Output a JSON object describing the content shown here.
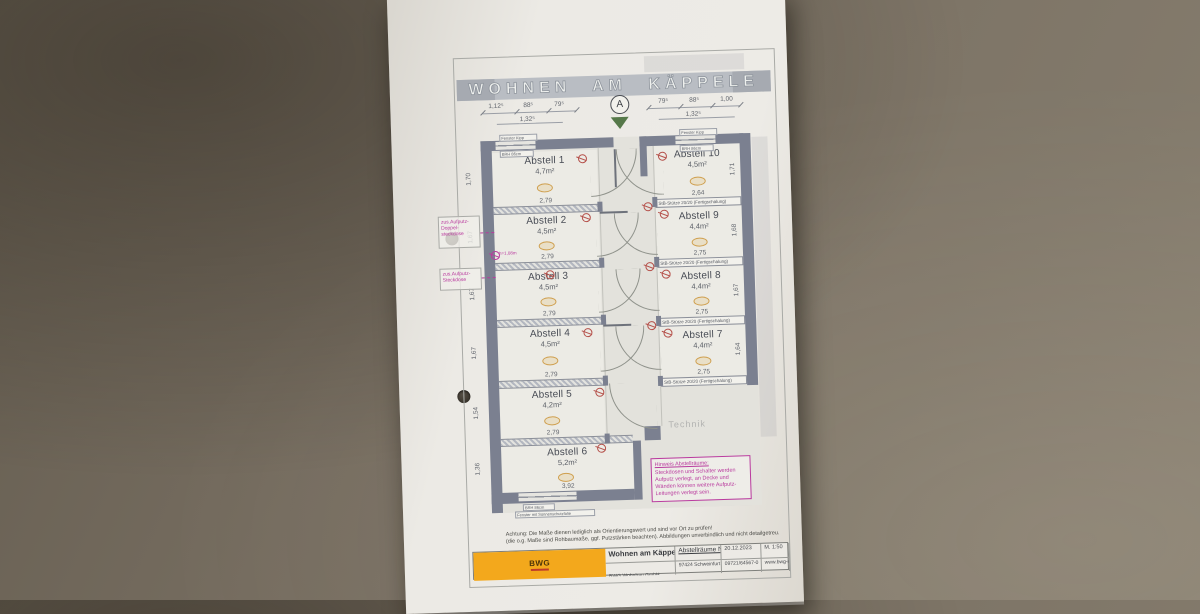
{
  "banner": {
    "title": "WOHNEN AM KÄPPELE"
  },
  "north": {
    "label": "A"
  },
  "dims": {
    "top_left": [
      "1,12⁵",
      "88⁵",
      "79⁵"
    ],
    "top_left_sub": "1,32⁵",
    "top_right": [
      "79⁵",
      "88⁵",
      "1,00"
    ],
    "top_right_sub": "1,32⁵"
  },
  "rooms_left": [
    {
      "name": "Abstell 1",
      "area": "4,7m²",
      "w": "2,79",
      "h": "1,70"
    },
    {
      "name": "Abstell 2",
      "area": "4,5m²",
      "w": "2,79",
      "h": "1,67"
    },
    {
      "name": "Abstell 3",
      "area": "4,5m²",
      "w": "2,79",
      "h": "1,67"
    },
    {
      "name": "Abstell 4",
      "area": "4,5m²",
      "w": "2,79",
      "h": "1,67"
    },
    {
      "name": "Abstell 5",
      "area": "4,2m²",
      "w": "2,79",
      "h": "1,54"
    },
    {
      "name": "Abstell 6",
      "area": "5,2m²",
      "w": "3,92",
      "h": "1,36"
    }
  ],
  "rooms_right": [
    {
      "name": "Abstell 10",
      "area": "4,5m²",
      "w": "2,64",
      "h": "1,71"
    },
    {
      "name": "Abstell 9",
      "area": "4,4m²",
      "w": "2,75",
      "h": "1,68"
    },
    {
      "name": "Abstell 8",
      "area": "4,4m²",
      "w": "2,75",
      "h": "1,67"
    },
    {
      "name": "Abstell 7",
      "area": "4,4m²",
      "w": "2,75",
      "h": "1,64"
    }
  ],
  "labels": {
    "column": "StB-Stütze 20/20 (Fertigschalung)",
    "technik": "Technik",
    "socket_height": "h=1,08m",
    "window_top_1": "Fenster Kipp",
    "window_top_2": "BRH 86cm",
    "window_bottom_1": "BRH 86cm",
    "window_bottom_2": "Fenster mit Sonnenschutzfolie"
  },
  "margin_notes": {
    "note1": "zus.Aufputz-Doppel-steckdose",
    "note2": "zus.Aufputz-Steckdose"
  },
  "hinweis": {
    "title": "Hinweis Abstellräume:",
    "body": "Steckdosen und Schalter werden Aufputz verlegt, an Decke und Wänden können weitere Aufputz-Leitungen verlegt sein."
  },
  "warning": {
    "line1": "Achtung: Die Maße dienen lediglich als Orientierungswert und sind vor Ort zu prüfen!",
    "line2": "(die o.g. Maße sind Rohbaumaße, ggf. Putzstärken beachten). Abbildungen unverbindlich und nicht detailgetreu."
  },
  "title_block": {
    "project": "Wohnen am Käppele",
    "company": "BWG Wohnbau GmbH",
    "street": "Athenstraße 10",
    "drawing": "Abstellräume Nr.32",
    "city": "97424 Schweinfurt",
    "date": "20.12.2023",
    "phone": "09721/64567-0",
    "scale": "M. 1:50",
    "website": "www.bwg-sw.de",
    "logo": "BWG"
  },
  "colors": {
    "wall": "#7b8090",
    "annotation_magenta": "#b93a9e",
    "electrical_red": "#b5504a",
    "marker_green": "#557849",
    "logo_orange": "#f3a81c",
    "paper": "#eceae5",
    "table": "#756c5f"
  }
}
